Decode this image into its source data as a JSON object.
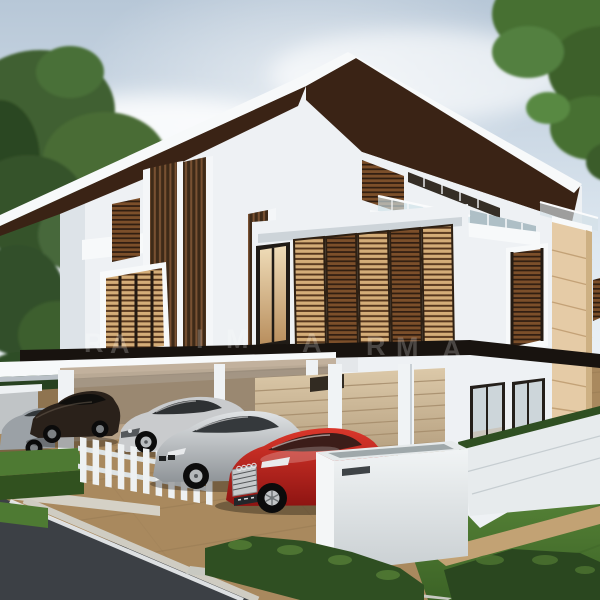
{
  "meta": {
    "scene": "3d-architectural-exterior-render",
    "subject": "modern detached white house with overhanging dark roofs, wooden louver shutters, carport, driveway with parked cars"
  },
  "watermark": {
    "color": "rgba(255,255,255,0.22)",
    "letters": [
      "R",
      "A",
      "I",
      "M",
      "A",
      "R",
      "M",
      "A"
    ]
  },
  "palette": {
    "sky_top": "#b7c7d7",
    "sky_mid": "#dde7f0",
    "sky_low": "#f3f7fa",
    "cloud": "#ffffff",
    "foliage_dark": "#33502a",
    "foliage_mid": "#47683a",
    "foliage_light": "#5d8447",
    "roof_underside": "#3a2315",
    "roof_fascia": "#f7f9fa",
    "wall_white": "#eef1f4",
    "wall_shade": "#dde3e8",
    "black_band": "#18130f",
    "stone_beige": "#e5cba6",
    "stone_groove": "#c3a277",
    "garage_door": "#cdb897",
    "garage_line": "#a58c6b",
    "glass": "#cdd6da",
    "driveway": "#a9895e",
    "paver_line": "#8a6f4c",
    "road": "#3c4045",
    "road_line": "#eceef0",
    "curb": "#c8c9c2",
    "walkway": "#d5d1c6",
    "path_tan": "#c2a274",
    "lawn": "#4f7c33",
    "hedge": "#2f4f22",
    "hedge_light": "#4e7a33",
    "fence_white": "#eef1f2",
    "letterbox": "#e9edee",
    "letterbox_slot": "#3f4447"
  },
  "objects": {
    "trees": [
      "tree-left",
      "tree-right"
    ],
    "house_features": [
      "main-roof",
      "left-wing-roof",
      "roof-terrace-railing",
      "wood-louver-screens",
      "balcony-shutters",
      "bay-window-louver",
      "stone-pillar",
      "carport",
      "garage-door",
      "picket-fence",
      "letterbox"
    ],
    "cars": [
      {
        "name": "convertible-grey",
        "color": "#9ba1a6"
      },
      {
        "name": "coupe-dark-brown",
        "color": "#2a211a"
      },
      {
        "name": "supercar-silver",
        "color": "#c9cbcd"
      },
      {
        "name": "coupe-silver",
        "color": "#c4c7ca"
      },
      {
        "name": "sedan-red",
        "color": "#c0251d"
      }
    ]
  }
}
